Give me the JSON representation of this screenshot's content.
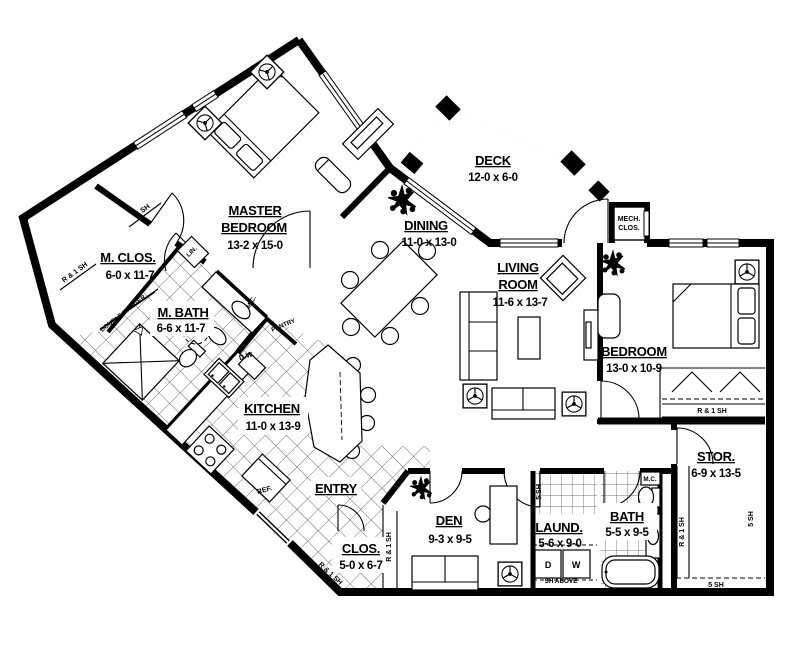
{
  "colors": {
    "wall": "#000000",
    "background": "#ffffff",
    "hatch_line": "#3a3a3a"
  },
  "rooms": {
    "master": {
      "l1": "MASTER",
      "l2": "BEDROOM",
      "dims": "13-2 x 15-0"
    },
    "mclos": {
      "name": "M. CLOS.",
      "dims": "6-0 x 11-7"
    },
    "mbath": {
      "name": "M. BATH",
      "dims": "6-6 x 11-7"
    },
    "kitchen": {
      "name": "KITCHEN",
      "dims": "11-0 x 13-9"
    },
    "dining": {
      "name": "DINING",
      "dims": "11-0 x 13-0"
    },
    "deck": {
      "name": "DECK",
      "dims": "12-0 x 6-0"
    },
    "living": {
      "l1": "LIVING",
      "l2": "ROOM",
      "dims": "11-6 x 13-7"
    },
    "bedroom": {
      "name": "BEDROOM",
      "dims": "13-0 x 10-9"
    },
    "stor": {
      "name": "STOR.",
      "dims": "6-9 x 13-5"
    },
    "bath": {
      "name": "BATH",
      "dims": "5-5 x 9-5"
    },
    "laund": {
      "name": "LAUND.",
      "dims": "5-6 x 9-0"
    },
    "den": {
      "name": "DEN",
      "dims": "9-3 x 9-5"
    },
    "clos": {
      "name": "CLOS.",
      "dims": "5-0 x 6-7"
    },
    "entry": {
      "name": "ENTRY"
    },
    "mech": {
      "l1": "MECH.",
      "l2": "CLOS."
    }
  },
  "labels": {
    "r1sh": "R & 1 SH",
    "sh5": "5 SH",
    "double_hanger": "DOUBLE HANGER",
    "lin": "LIN.",
    "pantry": "PANTRY",
    "dw": "D.W.",
    "ref": "REF.",
    "mc": "M.C.",
    "d": "D",
    "w": "W",
    "sh_above": "SH ABOVE"
  }
}
